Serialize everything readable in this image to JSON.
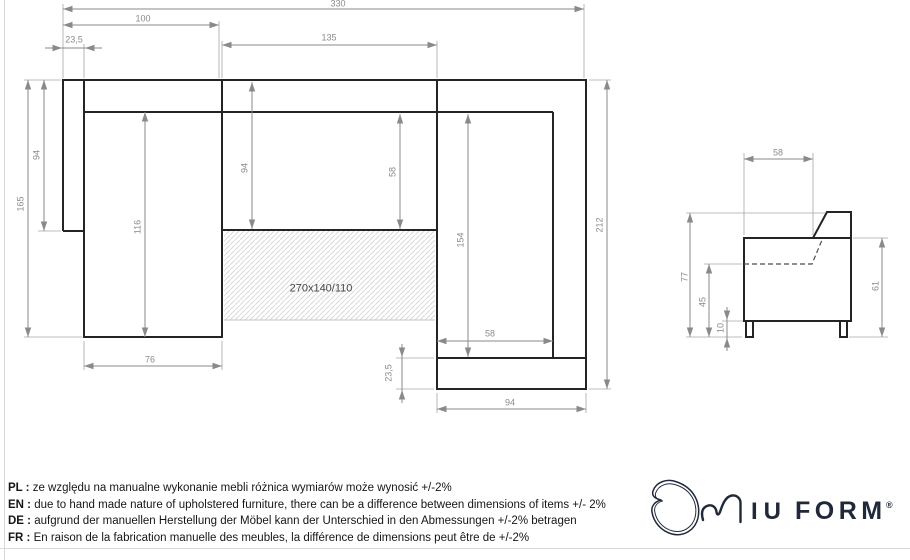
{
  "dims": {
    "total_width": "330",
    "left_section_width": "100",
    "left_arm_width": "23,5",
    "center_width": "135",
    "left_total_depth": "165",
    "left_back_depth": "94",
    "left_seat_length": "116",
    "center_depth": "94",
    "center_seat_depth": "58",
    "right_seat_length": "154",
    "right_seat_width": "58",
    "front_band_depth": "23,5",
    "right_section_width": "94",
    "right_total_depth": "212",
    "left_seat_width": "76",
    "sleeping_area": "270x140/110",
    "side_seat_depth": "58",
    "side_total_height": "77",
    "side_seat_height": "45",
    "side_leg_height": "10",
    "side_body_height": "61"
  },
  "notes": [
    {
      "label": "PL : ",
      "text": "ze względu na manualne wykonanie mebli różnica wymiarów może wynosić +/-2%"
    },
    {
      "label": "EN : ",
      "text": "due to hand made nature of upholstered furniture, there can be a difference between dimensions of items +/- 2%"
    },
    {
      "label": "DE : ",
      "text": "aufgrund der manuellen Herstellung der Möbel kann der Unterschied in den Abmessungen +/-2% betragen"
    },
    {
      "label": "FR : ",
      "text": "En raison de la fabrication manuelle des meubles, la différence de dimensions peut être de +/-2%"
    }
  ],
  "logo": {
    "brand": "MIUFORM",
    "wordmark_iu": "IU",
    "wordmark_form": "FORM",
    "registered": "®"
  },
  "colors": {
    "outline_ink": "#242424",
    "dimension_gray": "#8a8a8a",
    "hatch_gray": "#d9d9d9",
    "logo_ink": "#20293a",
    "note_text": "#161616"
  }
}
